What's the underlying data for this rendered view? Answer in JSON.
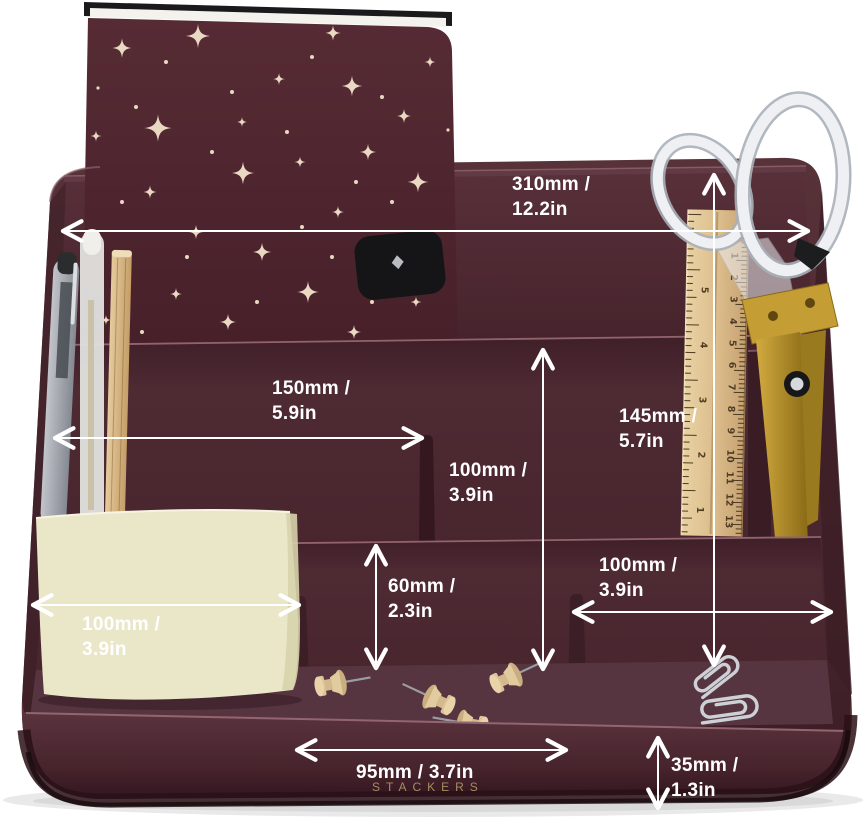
{
  "product": {
    "name": "desk organizer with stationery",
    "brand": "STACKERS"
  },
  "colors": {
    "body_dark": "#3a1c24",
    "body_mid": "#4e2a33",
    "body_light": "#5d3640",
    "floor": "#573540",
    "edge_highlight": "#966874",
    "base_shadow": "#240f15",
    "notebook": "#4f262f",
    "star": "#e9d8c2",
    "sticky_note": "#e9e6c5",
    "wood": "#d9ba8a",
    "gold": "#bb9730",
    "silver": "#cdd1d6",
    "annotation": "#ffffff",
    "brand_gold": "#a68c5f"
  },
  "annotations": {
    "back_width": {
      "line1": "310mm /",
      "line2": "12.2in"
    },
    "pen_section_width": {
      "line1": "150mm /",
      "line2": "5.9in"
    },
    "middle_height": {
      "line1": "100mm /",
      "line2": "3.9in"
    },
    "back_right_height": {
      "line1": "145mm /",
      "line2": "5.7in"
    },
    "front_height": {
      "line1": "60mm /",
      "line2": "2.3in"
    },
    "front_right_width": {
      "line1": "100mm /",
      "line2": "3.9in"
    },
    "front_left_width": {
      "line1": "100mm /",
      "line2": "3.9in"
    },
    "front_center_width": {
      "line1": "95mm / 3.7in"
    },
    "base_height": {
      "line1": "35mm /",
      "line2": "1.3in"
    }
  },
  "ruler": {
    "cm_numbers": [
      "1",
      "2",
      "3",
      "4",
      "5",
      "6",
      "7",
      "8",
      "9",
      "10",
      "11",
      "12",
      "13"
    ],
    "inch_numbers": [
      "5",
      "4",
      "3",
      "2",
      "1"
    ]
  },
  "brand_label": "STACKERS"
}
